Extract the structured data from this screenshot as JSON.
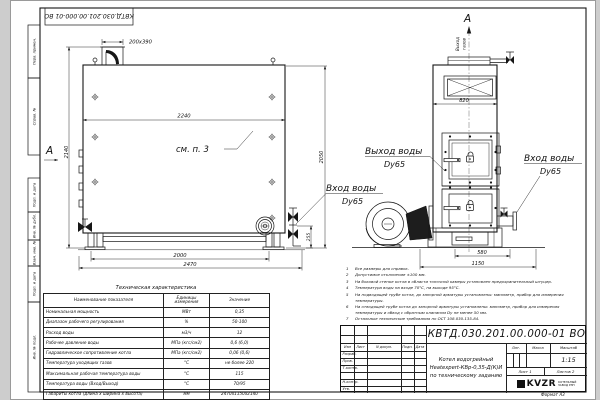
{
  "doc_number": "КВТД.030.201.00.000-01 ВО",
  "frame_cells": [
    "Перв. примен.",
    "Справ. №",
    "Подп. и дата",
    "Инв. № дубл.",
    "Взам. инв. №",
    "Подп. и дата",
    "Инв. № подл."
  ],
  "side_view": {
    "section_label": "А",
    "dim_chimney": "200х390",
    "dim_width": "2240",
    "dim_height": "2140",
    "see_note": "см. п. 3",
    "dim_feet": "2000",
    "dim_length": "2470",
    "dim_flange": "255",
    "dim_front_height": "2050"
  },
  "front_view": {
    "view_label": "А",
    "gas_out_1": "Выход",
    "gas_out_2": "газов",
    "dim_width": "820",
    "dim_base": "580",
    "dim_total": "1150"
  },
  "labels": {
    "water_out_1": "Выход воды",
    "water_out_2": "Dy65",
    "water_in_left_1": "Вход воды",
    "water_in_left_2": "Dy65",
    "water_in_right_1": "Вход воды",
    "water_in_right_2": "Dy65"
  },
  "notes": [
    {
      "num": "1",
      "text": "Все размеры для справок."
    },
    {
      "num": "2",
      "text": "Допустимое отклонение ±100 мм."
    },
    {
      "num": "3",
      "text": "На боковой стенке котла в области топочной камеры установлен предохранительный штуцер."
    },
    {
      "num": "4",
      "text": "Температура воды на входе 70°С, на выходе 95°С."
    },
    {
      "num": "5",
      "text": "На подводящей трубе котла, до запорной арматуры установлены: манометр, прибор для измерения температуры."
    },
    {
      "num": "6",
      "text": "На отводящей трубе котла до запорной арматуры установлены: манометр, прибор для измерения температуры и обвод с обратным клапаном Dу не менее 50 мм."
    },
    {
      "num": "7",
      "text": "Остальные технические требования по ОСТ 108.030.135-84."
    }
  ],
  "tech_table": {
    "title": "Техническая характеристика",
    "col_name": "Наименование показателя",
    "col_units": "Единицы измерения",
    "col_value": "Значение",
    "rows": [
      {
        "name": "Номинальная мощность",
        "unit": "МВт",
        "value": "0,35"
      },
      {
        "name": "Диапазон рабочего регулирования",
        "unit": "%",
        "value": "50-100"
      },
      {
        "name": "Расход воды",
        "unit": "м3/ч",
        "value": "12"
      },
      {
        "name": "Рабочее давление воды",
        "unit": "МПа (кгс/см2)",
        "value": "0,6 (6,0)"
      },
      {
        "name": "Гидравлическое сопротивление котла",
        "unit": "МПа (кгс/см2)",
        "value": "0,06 (0,6)"
      },
      {
        "name": "Температура уходящих газов",
        "unit": "°С",
        "value": "не более 220"
      },
      {
        "name": "Максимальная рабочая температура воды",
        "unit": "°С",
        "value": "115"
      },
      {
        "name": "Температура воды (Вход/Выход)",
        "unit": "°С",
        "value": "70/95"
      },
      {
        "name": "Габариты котла (длина х ширина х высота)",
        "unit": "мм",
        "value": "2470х1150х2140"
      }
    ]
  },
  "title_block": {
    "name_1": "Котел водогрейный",
    "name_2": "Heatexpert-КВр-0,35-Д(К)И",
    "name_3": "по техническому заданию",
    "col_izm": "Изм",
    "col_list": "Лист",
    "col_doc": "N докум.",
    "col_sign": "Подп.",
    "col_date": "Дата",
    "row_razrab": "Разраб.",
    "row_prov": "Пров.",
    "row_tkontr": "Т.контр.",
    "row_nkontr": "Н.контр.",
    "row_utv": "Утв.",
    "lit": "Лит.",
    "mass": "Масса",
    "scale_label": "Масштаб",
    "scale": "1:15",
    "sheet": "Лист 1",
    "sheets": "Листов 2",
    "logo": "KVZR",
    "company_1": "КОТЕЛЬНЫЙ",
    "company_2": "ЗАВОД РЭП",
    "format": "Формат А3"
  }
}
